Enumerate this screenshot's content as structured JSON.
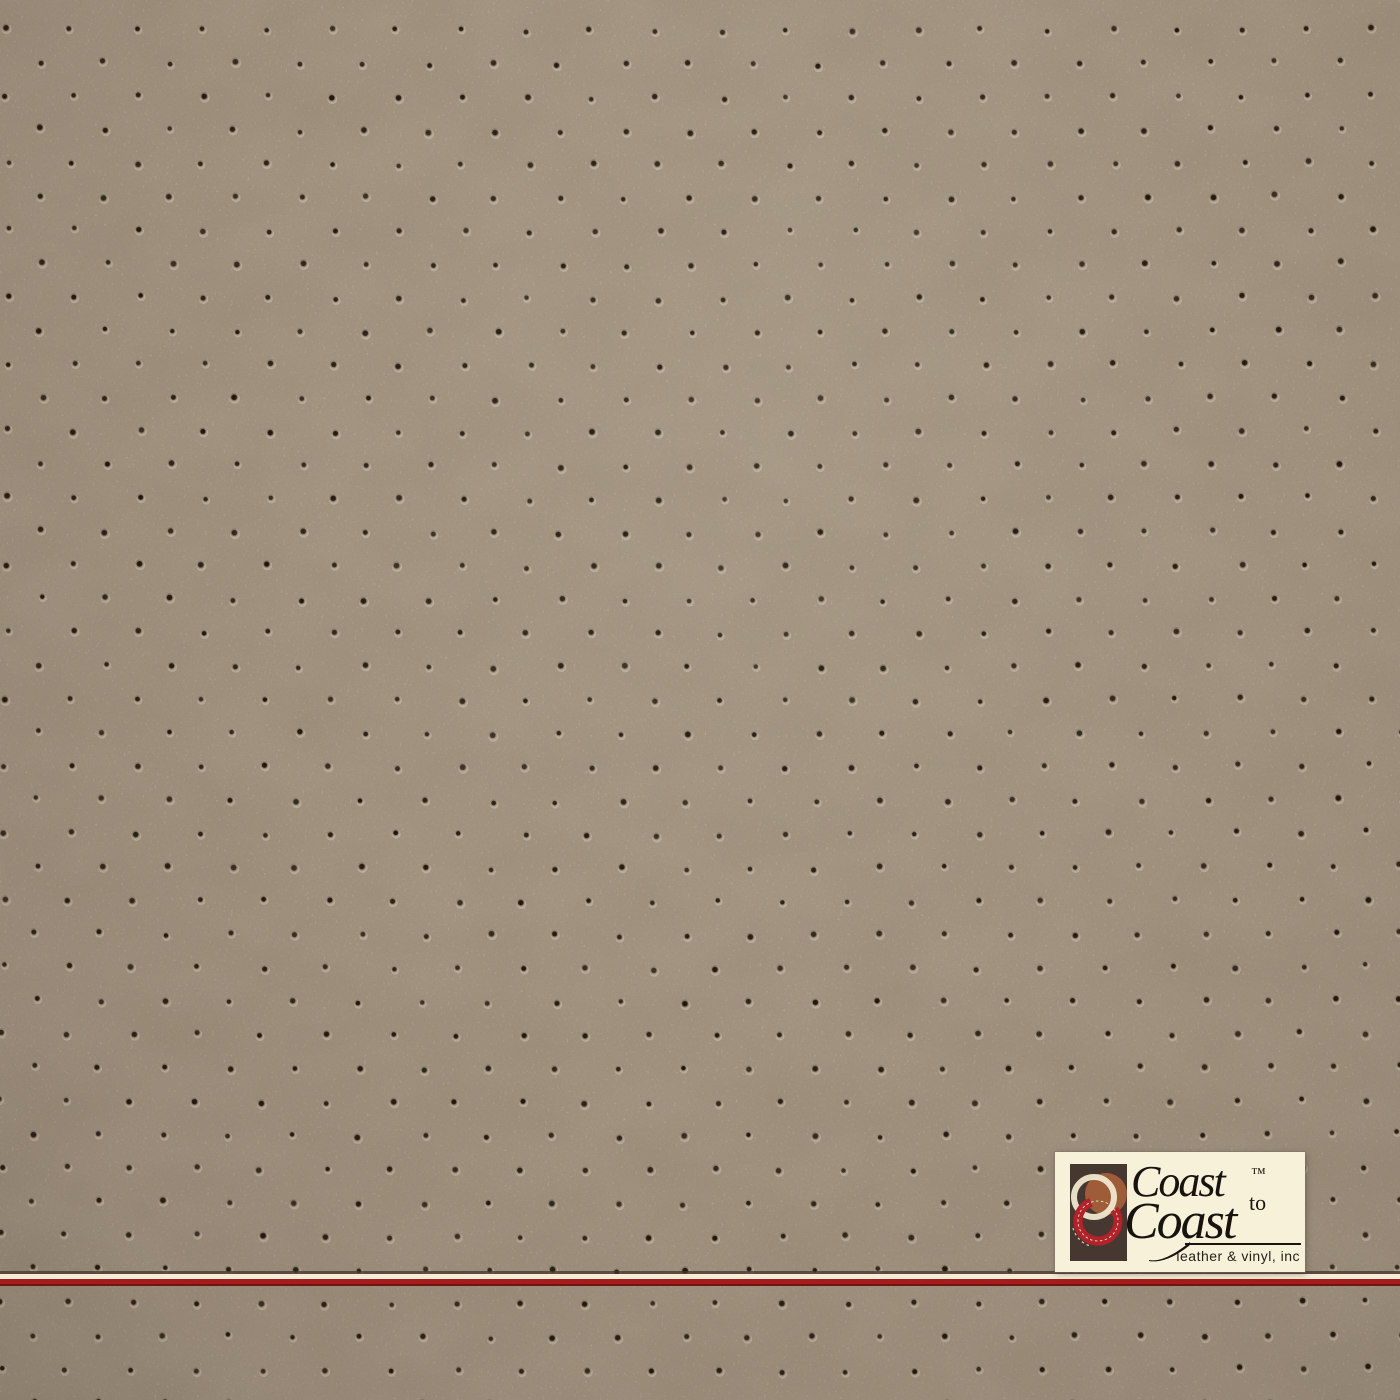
{
  "image": {
    "description": "Taupe perforated leather / vinyl upholstery swatch photo with brand watermark",
    "width": 1400,
    "height": 1400
  },
  "colors": {
    "leather_base": "#a29481",
    "leather_light": "#b5a693",
    "leather_dark": "#8c7e6c"
  },
  "pattern": {
    "type": "staggered-perforation",
    "spacing_x": 65,
    "spacing_y": 33.5,
    "row_offset": 32.5,
    "origin_x": 5,
    "origin_y": 28,
    "dot_radius": 3.7,
    "jitter": 2.6,
    "dot_color": "#1d1309",
    "highlight_color": "rgba(235,224,202,0.32)"
  },
  "stripe": {
    "shadow_color": "#43372a",
    "cream_color": "#f4eed6",
    "red_color": "#a21d1b"
  },
  "logo": {
    "plaque_color": "#f7f1d9",
    "line1": "Coast",
    "trademark": "™",
    "line1_suffix": "to",
    "line2": "Coast",
    "tagline": "leather & vinyl, inc",
    "text_color": "#17130e",
    "icon": {
      "bg": "#463831",
      "rust": "#9e5c38",
      "cream": "#f0e8cd",
      "red": "#b2222a"
    }
  }
}
